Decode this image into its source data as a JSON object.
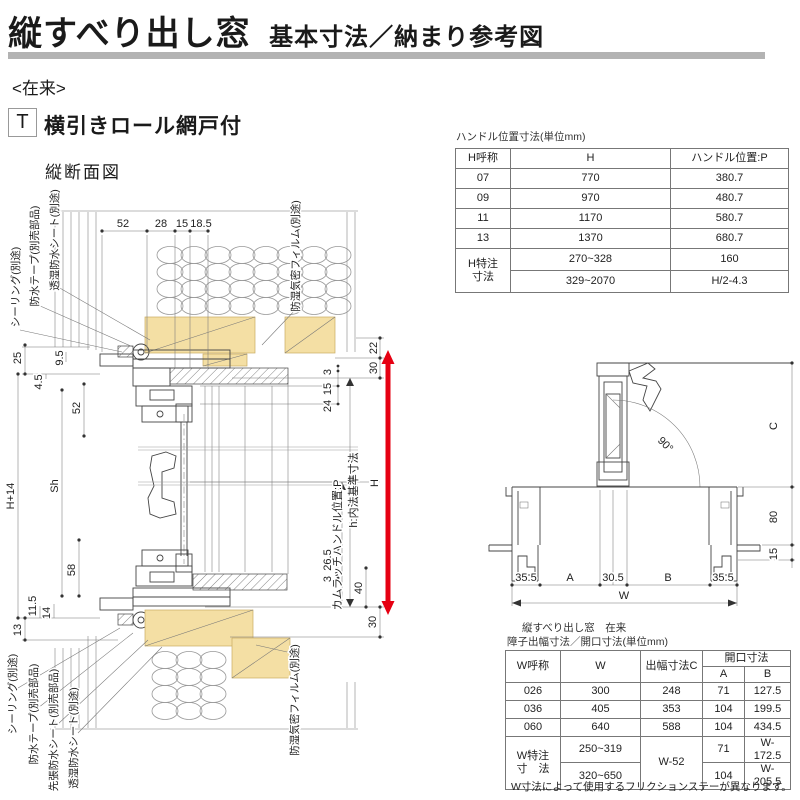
{
  "header": {
    "title": "縦すべり出し窓",
    "subtitle": "基本寸法／納まり参考図"
  },
  "meta": {
    "construction": "<在来>",
    "type_code": "T",
    "type_label": "横引きロール網戸付"
  },
  "vsection": {
    "title": "縦断面図",
    "top_dims": [
      "52",
      "28",
      "15",
      "18.5"
    ],
    "labels_top_left": [
      "シーリング(別途)",
      "防水テープ(別売部品)",
      "透湿防水シート(別途)"
    ],
    "label_film_top": "防湿気密フィルム(別途)",
    "dims_left": [
      "25",
      "9.5",
      "4.5",
      "52",
      "H+14",
      "Sh",
      "58",
      "11.5",
      "14",
      "13"
    ],
    "labels_bottom_left": [
      "シーリング(別途)",
      "防水テープ(別売部品)",
      "先張防水シート(別売部品)",
      "透湿防水シート(別途)"
    ],
    "label_film_bottom": "防湿気密フィルム(別途)",
    "dims_right": [
      "22",
      "30",
      "3",
      "15",
      "24",
      "26.5",
      "3",
      "40",
      "30"
    ],
    "label_inner_height": "h:内法基準寸法",
    "label_handle_pos": "カムラッチハンドル位置:P",
    "label_H": "H"
  },
  "plan": {
    "angle_label": "90°",
    "dim_c": "C",
    "dim_80": "80",
    "dim_15": "15",
    "bottom_dims": [
      "35.5",
      "A",
      "30.5",
      "B",
      "35.5"
    ],
    "dim_w": "W"
  },
  "handle_table": {
    "title": "ハンドル位置寸法(単位mm)",
    "col_headers": [
      "H呼称",
      "H",
      "ハンドル位置:P"
    ],
    "rows": [
      [
        "07",
        "770",
        "380.7"
      ],
      [
        "09",
        "970",
        "480.7"
      ],
      [
        "11",
        "1170",
        "580.7"
      ],
      [
        "13",
        "1370",
        "680.7"
      ]
    ],
    "special_row_label_1": "H特注",
    "special_row_label_2": "寸法",
    "special_rows": [
      [
        "270~328",
        "160"
      ],
      [
        "329~2070",
        "H/2-4.3"
      ]
    ]
  },
  "opening_table": {
    "title_line1": "縦すべり出し窓　在来",
    "title_line2": "障子出幅寸法／開口寸法(単位mm)",
    "col_w_name": "W呼称",
    "col_w": "W",
    "col_c": "出幅寸法C",
    "col_opening": "開口寸法",
    "col_a": "A",
    "col_b": "B",
    "rows": [
      [
        "026",
        "300",
        "248",
        "71",
        "127.5"
      ],
      [
        "036",
        "405",
        "353",
        "104",
        "199.5"
      ],
      [
        "060",
        "640",
        "588",
        "104",
        "434.5"
      ]
    ],
    "special_label_1": "W特注",
    "special_label_2": "寸　法",
    "special_w": [
      "250~319",
      "320~650"
    ],
    "special_c": "W-52",
    "special_ab": [
      [
        "71",
        "W-172.5"
      ],
      [
        "104",
        "W-205.5"
      ]
    ],
    "note": "W寸法によって使用するフリクションステーが異なります。"
  },
  "colors": {
    "accent_red": "#e60012",
    "wood": "#f4dfa4",
    "bar_gray": "#b3b3b3"
  }
}
